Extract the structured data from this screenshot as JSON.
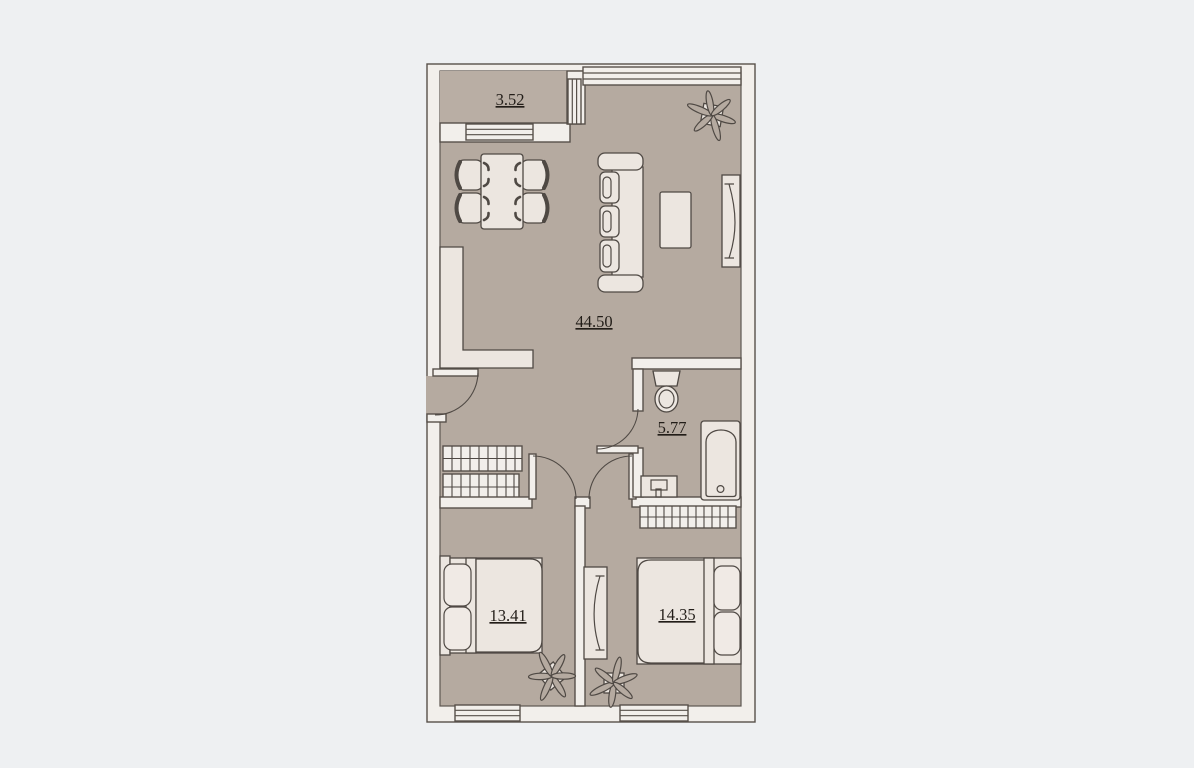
{
  "plan": {
    "balcony": {
      "area": "3.52"
    },
    "living_room": {
      "area": "44.50"
    },
    "bathroom": {
      "area": "5.77"
    },
    "bedroom_1": {
      "area": "13.41"
    },
    "bedroom_2": {
      "area": "14.35"
    }
  },
  "colors": {
    "background": "#eef0f2",
    "floor": "#b5aaa0",
    "wall": "#f2efeb",
    "outline": "#57504a",
    "furniture": "#ece6e0",
    "text": "#221d18"
  },
  "icons": {
    "living_room": [
      "kitchen-counter",
      "dining-table",
      "dining-chair",
      "sofa",
      "coffee-table",
      "tv-panel",
      "plant",
      "hall-cabinet",
      "window"
    ],
    "bathroom": [
      "toilet",
      "bathtub",
      "washbasin"
    ],
    "bedroom_1": [
      "double-bed",
      "plant",
      "window"
    ],
    "bedroom_2": [
      "double-bed",
      "wardrobe-panel",
      "radiator",
      "plant",
      "window"
    ],
    "doors": [
      "entrance-door",
      "bathroom-door",
      "bedroom-1-door",
      "bedroom-2-door"
    ]
  }
}
